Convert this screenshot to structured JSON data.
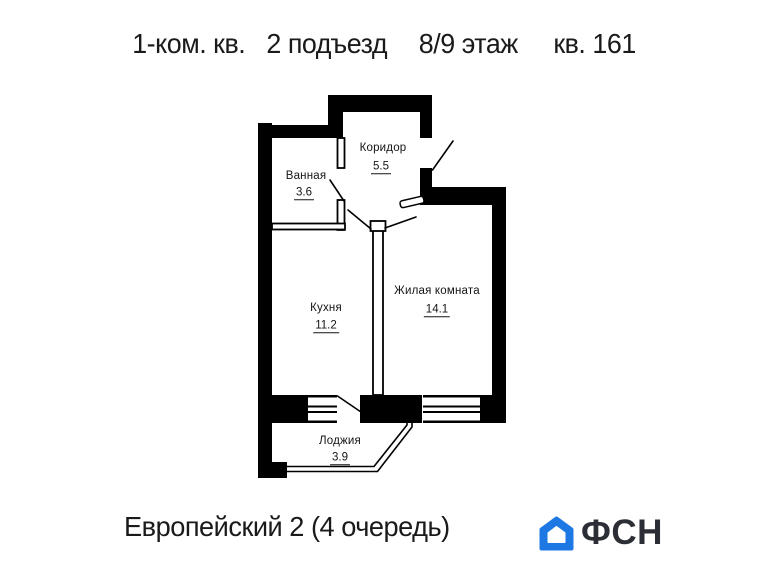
{
  "header": {
    "title_parts": [
      "1-ком. кв.",
      "2 подъезд",
      "8/9 этаж",
      "кв. 161"
    ]
  },
  "plan": {
    "rooms": [
      {
        "name": "Коридор",
        "area": "5.5"
      },
      {
        "name": "Ванная",
        "area": "3.6"
      },
      {
        "name": "Кухня",
        "area": "11.2"
      },
      {
        "name": "Жилая комната",
        "area": "14.1"
      },
      {
        "name": "Лоджия",
        "area": "3.9"
      }
    ],
    "wall_color": "#000000"
  },
  "footer": {
    "project": "Европейский 2 (4 очередь)",
    "logo_text": "ФСН",
    "logo_color": "#1d78e4",
    "logo_text_color": "#2b2f35"
  }
}
